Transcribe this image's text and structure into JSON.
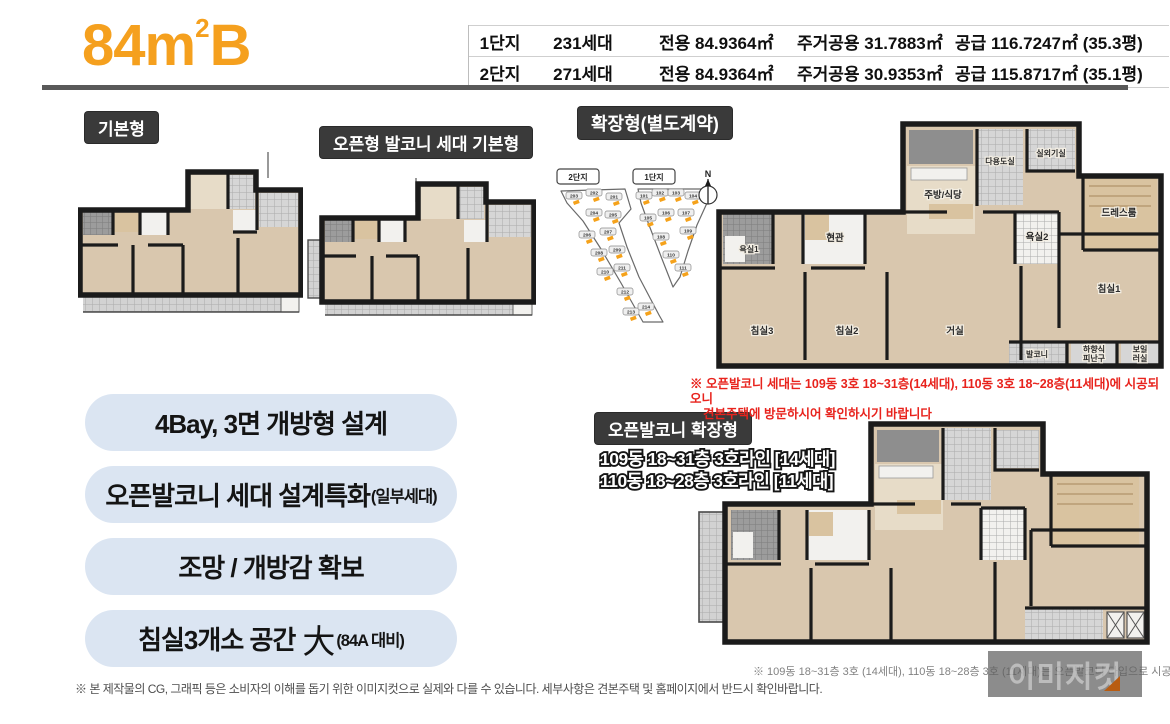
{
  "accent": {
    "orange": "#F5A01E",
    "dark_label_bg": "#3A3A3A",
    "pill_bg": "#DBE5F2",
    "red": "#E8231D",
    "divider_gray": "#595959"
  },
  "header": {
    "title": {
      "base": "84m",
      "sup": "2",
      "tail": "B"
    },
    "table": {
      "rows": [
        {
          "complex": "1단지",
          "units": "231세대",
          "exclusive": "전용 84.9364㎡",
          "common": "주거공용 31.7883㎡",
          "supply": "공급 116.7247㎡ (35.3평)"
        },
        {
          "complex": "2단지",
          "units": "271세대",
          "exclusive": "전용 84.9364㎡",
          "common": "주거공용 30.9353㎡",
          "supply": "공급 115.8717㎡ (35.1평)"
        }
      ]
    }
  },
  "sections": {
    "basic_label": "기본형",
    "open_basic_label": "오픈형 발코니 세대 기본형",
    "extended_label": "확장형(별도계약)",
    "open_extended_label": "오픈발코니 확장형",
    "open_extended_lines": [
      "109동 18~31층 3호라인 [14세대]",
      "110동 18~28층 3호라인 [11세대]"
    ]
  },
  "site_plan": {
    "complex2_label": "2단지",
    "complex1_label": "1단지",
    "compass": "N",
    "complex2_buildings": [
      "203",
      "202",
      "201",
      "204",
      "205",
      "206",
      "207",
      "208",
      "209",
      "210",
      "211",
      "212",
      "213",
      "214"
    ],
    "complex1_buildings": [
      "101",
      "102",
      "103",
      "104",
      "105",
      "106",
      "107",
      "108",
      "109",
      "110",
      "111"
    ]
  },
  "rooms": {
    "outdoor_unit": "실외기실",
    "utility": "다용도실",
    "kitchen": "주방/식당",
    "dress": "드레스룸",
    "bath2": "욕실2",
    "entrance": "현관",
    "bath1": "욕실1",
    "bed1": "침실1",
    "bed2": "침실2",
    "bed3": "침실3",
    "living": "거실",
    "balcony": "발코니",
    "escape_line1": "하향식",
    "escape_line2": "피난구",
    "boiler_line1": "보일",
    "boiler_line2": "러실"
  },
  "features": [
    {
      "text": "4Bay, 3면 개방형 설계",
      "big": "",
      "suffix": ""
    },
    {
      "text": "오픈발코니 세대 설계특화",
      "big": "",
      "suffix": "(일부세대)"
    },
    {
      "text": "조망 / 개방감 확보",
      "big": "",
      "suffix": ""
    },
    {
      "text": "침실3개소 공간",
      "big": "大",
      "suffix": "(84A 대비)"
    }
  ],
  "notes": {
    "open_balcony_line1": "※ 오픈발코니 세대는 109동 3호 18~31층(14세대), 110동 3호 18~28층(11세대)에 시공되오니",
    "open_balcony_line2": "견본주택에 방문하시어 확인하시기 바랍니다",
    "plan_caption": "※ 109동 18~31층 3호 (14세대), 110동 18~28층 3호 (11세대)는 오픈발코니 타입으로 시공됩니다",
    "disclaimer": "※ 본 제작물의 CG, 그래픽 등은 소비자의 이해를 돕기 위한 이미지컷으로 실제와 다를 수 있습니다. 세부사항은 견본주택 및 홈페이지에서 반드시 확인바랍니다."
  },
  "watermark": "이미지컷"
}
